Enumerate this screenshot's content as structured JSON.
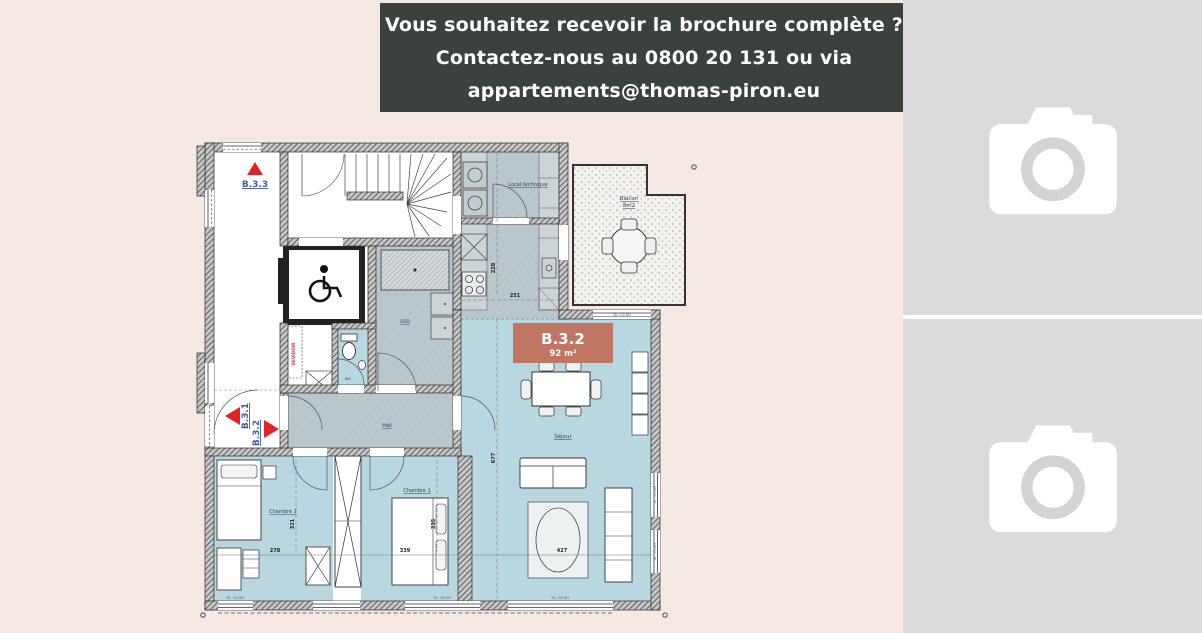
{
  "banner": {
    "line1": "Vous souhaitez recevoir la brochure complète ?",
    "line2": "Contactez-nous au 0800 20 131 ou via",
    "line3": "appartements@thomas-piron.eu",
    "bg_color": "#3b413c",
    "text_color": "#ffffff"
  },
  "placeholders": {
    "count": 2,
    "bg_color": "#dbdbdb",
    "icon": "camera-icon",
    "icon_color": "#ffffff",
    "lens_color": "#d4d4d4"
  },
  "floorplan": {
    "unit_label": {
      "title": "B.3.2",
      "area": "92 m²",
      "bg_color": "#c17663"
    },
    "apartment_ids": {
      "b33": "B.3.3",
      "b31": "B.3.1",
      "b32": "B.3.2"
    },
    "rooms": {
      "local_technique": "Local technique",
      "balcon": "Balcon",
      "balcon_area": "8m2",
      "sejour": "Séjour",
      "hall": "Hall",
      "sdd": "SDD",
      "wc": "WC",
      "chambre1": "Chambre 1",
      "chambre2": "Chambre 2",
      "devidoir": "DEVIDOIR"
    },
    "dimensions": {
      "chambre2_width": "278",
      "chambre1_width": "339",
      "sejour_width": "427",
      "chambre2_depth": "321",
      "chambre1_depth": "335",
      "sejour_depth": "677",
      "kitchen_width": "251",
      "kitchen_depth": "228"
    },
    "window_label": "TA : 00 DH",
    "colors": {
      "room_blue": "#b9d7e1",
      "room_gray": "#bac7cc",
      "wall": "#3a3a3a",
      "accent_red": "#e32227",
      "label_blue": "#3f5fa8",
      "background_pink": "#f6e9e4"
    }
  }
}
